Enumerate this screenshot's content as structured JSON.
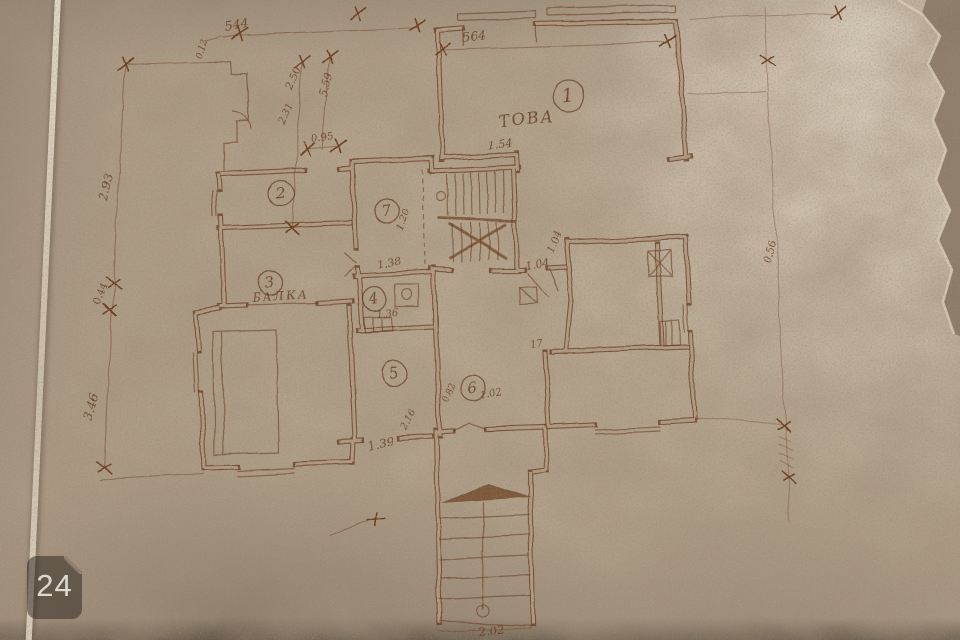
{
  "photo": {
    "watermark": "24"
  },
  "colors": {
    "paper": "#ad9c86",
    "paper_light": "#d8cdb9",
    "ink": "#5f3317",
    "wall_ink": "#6a3a1e",
    "badge_bg": "rgba(40,34,27,0.5)",
    "badge_text": "#f1ede3"
  },
  "plan": {
    "room_labels": [
      {
        "n": "1",
        "x": 568,
        "y": 95,
        "r": 15
      },
      {
        "n": "2",
        "x": 281,
        "y": 193,
        "r": 13
      },
      {
        "n": "3",
        "x": 271,
        "y": 283,
        "r": 12
      },
      {
        "n": "7",
        "x": 387,
        "y": 211,
        "r": 12
      },
      {
        "n": "4",
        "x": 374,
        "y": 299,
        "r": 12
      },
      {
        "n": "5",
        "x": 394,
        "y": 374,
        "r": 13
      },
      {
        "n": "6",
        "x": 473,
        "y": 388,
        "r": 13
      }
    ],
    "texts": [
      {
        "label": "ТОВА",
        "x": 528,
        "y": 124,
        "rot": -7,
        "size": 16
      },
      {
        "label": "БАЛКА",
        "x": 281,
        "y": 300,
        "rot": -4,
        "size": 12
      }
    ],
    "dimensions": [
      {
        "text": "544",
        "x": 237,
        "y": 29,
        "rot": -9,
        "size": 13
      },
      {
        "text": "0.12",
        "x": 205,
        "y": 49,
        "rot": -72,
        "size": 9
      },
      {
        "text": "564",
        "x": 474,
        "y": 41,
        "rot": -6,
        "size": 13
      },
      {
        "text": "2.50",
        "x": 297,
        "y": 80,
        "rot": -68,
        "size": 11
      },
      {
        "text": "2.31",
        "x": 288,
        "y": 115,
        "rot": -66,
        "size": 10
      },
      {
        "text": "5.59",
        "x": 330,
        "y": 86,
        "rot": -74,
        "size": 11
      },
      {
        "text": "0.95",
        "x": 323,
        "y": 141,
        "rot": -8,
        "size": 10
      },
      {
        "text": "2.93",
        "x": 110,
        "y": 188,
        "rot": -76,
        "size": 12
      },
      {
        "text": "0.44",
        "x": 103,
        "y": 294,
        "rot": -72,
        "size": 10
      },
      {
        "text": "3.46",
        "x": 95,
        "y": 408,
        "rot": -76,
        "size": 12
      },
      {
        "text": "1.54",
        "x": 500,
        "y": 148,
        "rot": -6,
        "size": 11
      },
      {
        "text": "1.20",
        "x": 406,
        "y": 221,
        "rot": -70,
        "size": 10
      },
      {
        "text": "1.38",
        "x": 390,
        "y": 266,
        "rot": -10,
        "size": 11
      },
      {
        "text": "1.36",
        "x": 388,
        "y": 316,
        "rot": -7,
        "size": 10
      },
      {
        "text": "1.04",
        "x": 538,
        "y": 268,
        "rot": -8,
        "size": 11
      },
      {
        "text": "1.04",
        "x": 557,
        "y": 243,
        "rot": -68,
        "size": 10
      },
      {
        "text": "0.82",
        "x": 451,
        "y": 393,
        "rot": -70,
        "size": 9
      },
      {
        "text": "1.02",
        "x": 492,
        "y": 397,
        "rot": -9,
        "size": 10
      },
      {
        "text": "2.16",
        "x": 411,
        "y": 421,
        "rot": -62,
        "size": 10
      },
      {
        "text": "1.39",
        "x": 382,
        "y": 447,
        "rot": -12,
        "size": 12
      },
      {
        "text": "17",
        "x": 537,
        "y": 347,
        "rot": -10,
        "size": 10
      },
      {
        "text": "0.56",
        "x": 772,
        "y": 252,
        "rot": -78,
        "size": 10
      },
      {
        "text": "2.02",
        "x": 492,
        "y": 635,
        "rot": -7,
        "size": 12
      }
    ]
  }
}
